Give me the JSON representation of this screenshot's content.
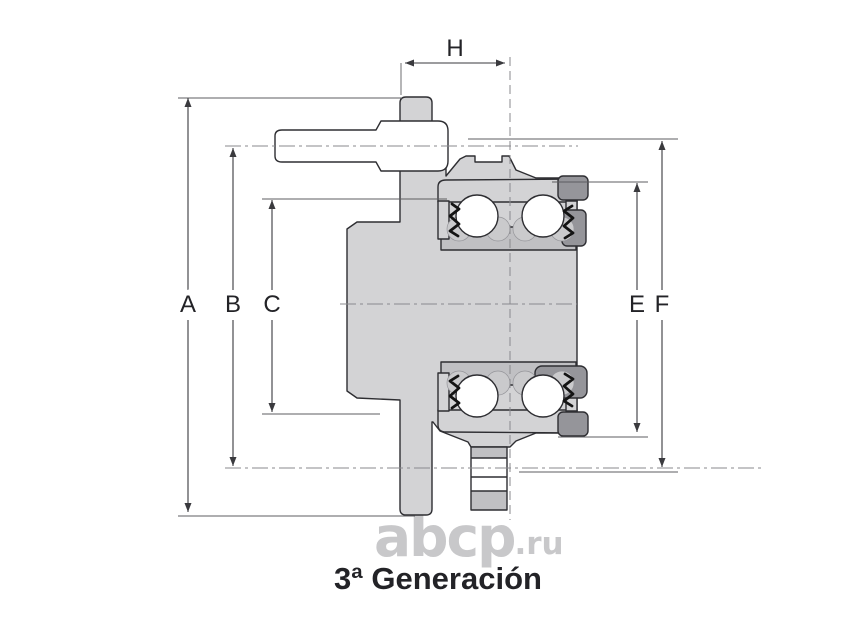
{
  "labels": {
    "A": "A",
    "B": "B",
    "C": "C",
    "E": "E",
    "F": "F",
    "H": "H"
  },
  "caption": "3ª Generación",
  "watermark": {
    "main": "abcp",
    "suffix": ".ru"
  },
  "colors": {
    "body": "#d3d3d5",
    "shade": "#c0c0c3",
    "dark": "#95959a",
    "outline": "#2e2e32",
    "dimension": "#3a3a3e",
    "extension": "#5c5c60",
    "centerline": "#8a8a8e",
    "seal": "#141414",
    "cage": "#cacacc",
    "watermark": "#c8c8ca",
    "caption": "#232327"
  }
}
